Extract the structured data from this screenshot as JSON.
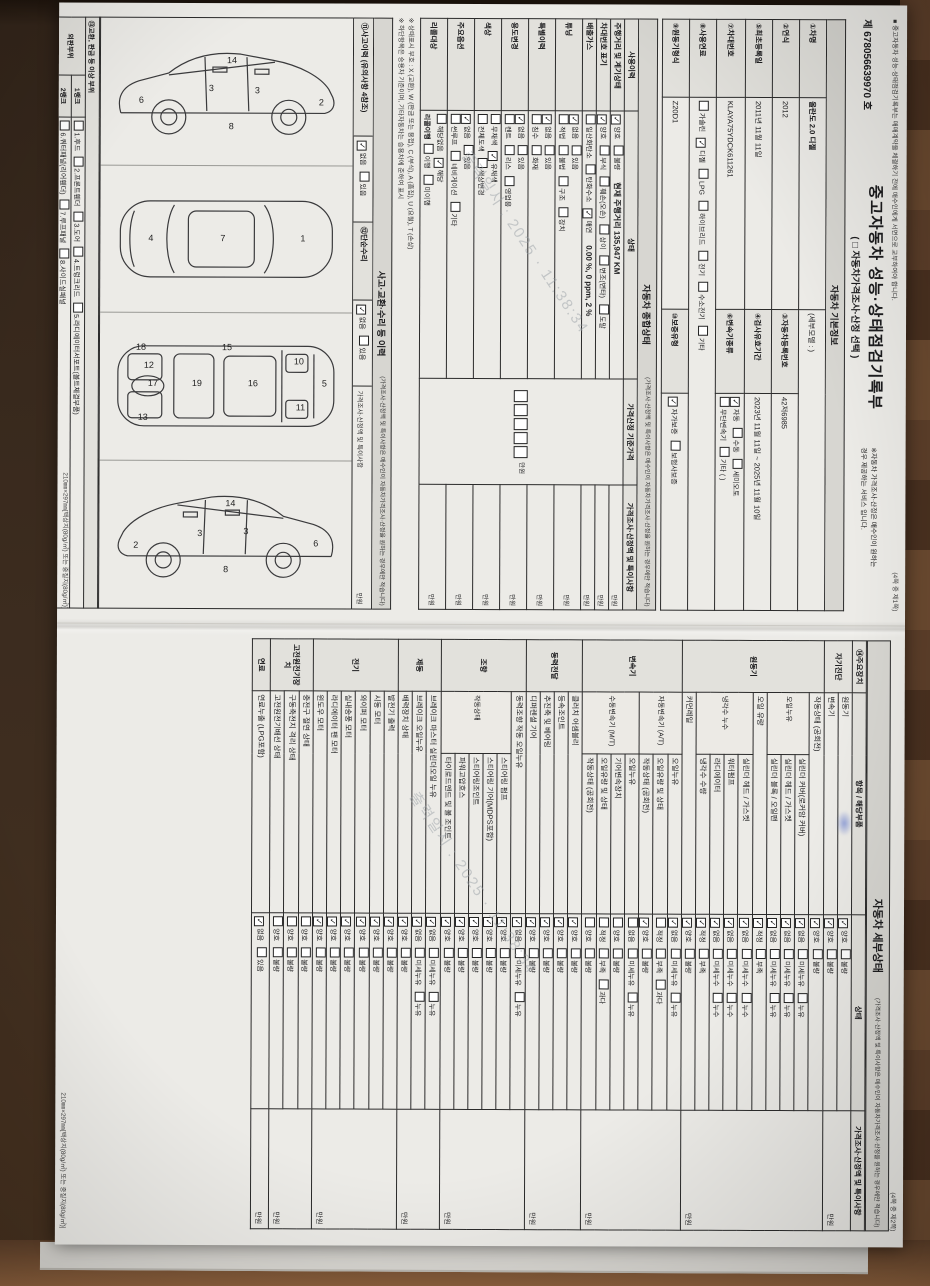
{
  "photo": {
    "watermark_line1": "출력일시 : 2025",
    "watermark_line2": "11:38:34"
  },
  "doc_number": "제 678056639970 호",
  "title": "중고자동차 성능·상태점검기록부",
  "title_sub": "( □ 자동차가격조사·산정 선택 )",
  "title_note1": "※자동차 가격조사·산정은 매수인이 원하는",
  "title_note2": "경우 제공하는 서비스 입니다.",
  "top_notice": "■ 중고자동차 성능·상태점검기록부는 매매계약을 체결하기 전에 매수인에게 서면으로 교부하여야 합니다.",
  "page1_marker": "(4쪽 중 제1쪽)",
  "page2_marker": "(4쪽 중 제2쪽)",
  "footer_spec": "210㎜×297㎜[백상지(80g/㎡) 또는 중질지(80g/㎡)]",
  "price_note": "(가격조사·산정액 및 특이사항은 매수인이 자동차가격조사·산정을 원하는 경우에만 적습니다)",
  "section_basic": "자동차 기본정보",
  "section_overall": "자동차 종합상태",
  "section_accident": "사고·교환·수리 등 이력",
  "section_detail": "자동차 세부상태",
  "basic": {
    "f1_label": "①차명",
    "f1_value": "올란도 2.0 디젤",
    "f1_extra": "(세부모델 : )",
    "f2_label": "②연식",
    "f2_value": "2012",
    "f3_label": "③자동차등록번호",
    "f3_value": "42저6985",
    "f4_label": "④검사유효기간",
    "f4_value": "2023년 11월 11일 ~ 2025년 11월 10일",
    "f5_label": "⑤최초등록일",
    "f5_value": "2011년 11월 11일",
    "f6_label": "⑥변속기종류",
    "trans_options1": [
      [
        "자동",
        1
      ],
      [
        "수동",
        0
      ],
      [
        "세미오토",
        0
      ]
    ],
    "trans_options2": [
      [
        "무단변속기",
        0
      ],
      [
        "기타 (      )",
        0
      ]
    ],
    "f7_label": "⑦차대번호",
    "f7_value": "KLAYA75YDCK611261",
    "f8_label": "⑧사용연료",
    "fuel_options": [
      [
        "가솔린",
        0
      ],
      [
        "디젤",
        1
      ],
      [
        "LPG",
        0
      ],
      [
        "하이브리드",
        0
      ],
      [
        "전기",
        0
      ],
      [
        "수소전기",
        0
      ],
      [
        "기타",
        0
      ]
    ],
    "f9_label": "⑨원동기형식",
    "f9_value": "Z20D1",
    "f10_label": "⑩보증유형",
    "warranty_options": [
      [
        "자가보증",
        1
      ],
      [
        "보험사보증",
        0
      ]
    ]
  },
  "overall": {
    "header": [
      "사용이력",
      "상태",
      "가격산정 기준가격",
      "가격조사·산정액 및 특이사항"
    ],
    "price_unit": "만원",
    "rows": [
      {
        "label": "주행거리 및 계기상태",
        "opts": [
          [
            "양호",
            1
          ],
          [
            "불량",
            0
          ]
        ],
        "note": "현재 주행거리  135,947 KM"
      },
      {
        "label": "차대번호 표기",
        "opts": [
          [
            "양호",
            1
          ],
          [
            "부식",
            0
          ],
          [
            "훼손(오손)",
            0
          ],
          [
            "상이",
            0
          ],
          [
            "변조(변타)",
            0
          ],
          [
            "도말",
            0
          ]
        ]
      },
      {
        "label": "배출가스",
        "opts": [
          [
            "일산화탄소",
            0
          ],
          [
            "탄화수소",
            0
          ],
          [
            "매연",
            1
          ]
        ],
        "note": "0.00 %,  0 ppm,  2 %"
      },
      {
        "label": "튜닝",
        "opts": [
          [
            "없음",
            1
          ],
          [
            "있음",
            0
          ]
        ],
        "opts2": [
          [
            "적법",
            0
          ],
          [
            "불법",
            0
          ]
        ],
        "opts3": [
          [
            "구조",
            0
          ],
          [
            "장치",
            0
          ]
        ]
      },
      {
        "label": "특별이력",
        "opts": [
          [
            "없음",
            1
          ],
          [
            "있음",
            0
          ]
        ],
        "opts2": [
          [
            "침수",
            0
          ],
          [
            "화재",
            0
          ]
        ]
      },
      {
        "label": "용도변경",
        "opts": [
          [
            "없음",
            1
          ],
          [
            "있음",
            0
          ]
        ],
        "opts2": [
          [
            "렌트",
            0
          ],
          [
            "리스",
            0
          ],
          [
            "영업용",
            0
          ]
        ]
      },
      {
        "label": "색상",
        "opts": [
          [
            "무채색",
            0
          ],
          [
            "유채색",
            1
          ]
        ],
        "opts2": [
          [
            "전체도색",
            0
          ],
          [
            "색상변경",
            0
          ]
        ]
      },
      {
        "label": "주요옵션",
        "opts": [
          [
            "없음",
            1
          ],
          [
            "있음",
            0
          ]
        ],
        "opts2": [
          [
            "썬루프",
            0
          ],
          [
            "네비게이션",
            0
          ],
          [
            "기타",
            0
          ]
        ]
      },
      {
        "label": "리콜대상",
        "opts": [
          [
            "해당없음",
            0
          ],
          [
            "해당",
            1
          ]
        ],
        "sub2": "리콜이행",
        "opts2": [
          [
            "이행",
            0
          ],
          [
            "미이행",
            0
          ]
        ]
      }
    ]
  },
  "legend_note1": "※ 상태표시 부호 :  X (교환),  W (판금 또는 용접),  C (부식),  A (흠집),  U (요철),  T (손상)",
  "legend_note2": "※ 하단항목은 승용차 기준이며, 기타자동차는 승용차에 준하여 표시",
  "accident": {
    "history_label": "⑪사고이력 (유의사항 4참조)",
    "history_options": [
      [
        "없음",
        1
      ],
      [
        "있음",
        0
      ]
    ],
    "repair_label": "⑫단순수리",
    "repair_options": [
      [
        "없음",
        1
      ],
      [
        "있음",
        0
      ]
    ],
    "price_header": "가격조사·산정액 및 특이사항",
    "price_unit": "만원",
    "exchange_label": "⑬교환, 판금 등 이상 부위",
    "check_rows": [
      {
        "group": "외판부위",
        "gspan": 2,
        "rank": "1랭크",
        "items": [
          {
            "t": "1.후드"
          },
          {
            "t": "2.프론트휀더"
          },
          {
            "t": "3.도어"
          },
          {
            "t": "4.트렁크리드"
          },
          {
            "t": "5.라디에이터서포트(볼트체결부품)"
          }
        ]
      },
      {
        "rank": "2랭크",
        "items": [
          {
            "t": "6.쿼터패널(리어휀더)"
          },
          {
            "t": "7.루프패널"
          },
          {
            "t": "8.사이드실패널"
          }
        ]
      },
      {
        "group": "주요골격",
        "gspan": 3,
        "rank": "A랭크",
        "items": [
          {
            "t": "9.프론트패널"
          },
          {
            "t": "10.크로스멤버"
          },
          {
            "t": "11.인사이드패널"
          }
        ]
      },
      {
        "rank": "B랭크",
        "items": [
          {
            "t": "12.사이드멤버"
          },
          {
            "t": "13.휠하우스"
          },
          {
            "t": "14.필러패널",
            "sub": [
              "A",
              "B",
              "C"
            ]
          },
          {
            "t": "15.대쉬패널"
          }
        ]
      },
      {
        "rank": "C랭크",
        "items": [
          {
            "t": "16.플로어패널"
          },
          {
            "t": "17.트렁크플로어"
          },
          {
            "t": "18.리어패널"
          },
          {
            "t": "19.패키지트레이"
          }
        ]
      }
    ],
    "diagrams": {
      "side_right": [
        "6",
        "3",
        "3",
        "2",
        "8",
        "14"
      ],
      "top": [
        "4",
        "7",
        "1"
      ],
      "underbody": [
        "18",
        "12",
        "17",
        "19",
        "13",
        "16",
        "15",
        "10",
        "11",
        "5"
      ],
      "side_left": [
        "2",
        "3",
        "3",
        "6",
        "8",
        "14"
      ]
    }
  },
  "detail": {
    "header": [
      "⑭주요장치",
      "항목 / 해당부품",
      "상태",
      "가격조사·산정액 및 특이사항"
    ],
    "state_header": "상태",
    "price_unit": "만원",
    "sections": [
      {
        "n": "자기진단",
        "rows": [
          {
            "l": "원동기",
            "o": [
              [
                "양호",
                1
              ],
              [
                "불량",
                0
              ]
            ]
          },
          {
            "l": "변속기",
            "o": [
              [
                "양호",
                1
              ],
              [
                "불량",
                0
              ]
            ]
          }
        ]
      },
      {
        "n": "원동기",
        "rows": [
          {
            "l": "작동상태 (공회전)",
            "o": [
              [
                "양호",
                1
              ],
              [
                "불량",
                0
              ]
            ]
          },
          {
            "g": "오일누유",
            "s": 3,
            "l": "실린더 커버(로커암 커버)",
            "o": [
              [
                "없음",
                1
              ],
              [
                "미세누유",
                0
              ],
              [
                "누유",
                0
              ]
            ]
          },
          {
            "l": "실린더 헤드 / 가스켓",
            "o": [
              [
                "없음",
                1
              ],
              [
                "미세누유",
                0
              ],
              [
                "누유",
                0
              ]
            ]
          },
          {
            "l": "실린더 블록 / 오일팬",
            "o": [
              [
                "없음",
                1
              ],
              [
                "미세누유",
                0
              ],
              [
                "누유",
                0
              ]
            ]
          },
          {
            "l": "오일 유량",
            "o": [
              [
                "적정",
                1
              ],
              [
                "부족",
                0
              ]
            ]
          },
          {
            "g": "냉각수 누수",
            "s": 4,
            "l": "실린더 헤드 / 가스켓",
            "o": [
              [
                "없음",
                1
              ],
              [
                "미세누수",
                0
              ],
              [
                "누수",
                0
              ]
            ]
          },
          {
            "l": "워터펌프",
            "o": [
              [
                "없음",
                1
              ],
              [
                "미세누수",
                0
              ],
              [
                "누수",
                0
              ]
            ]
          },
          {
            "l": "라디에이터",
            "o": [
              [
                "없음",
                1
              ],
              [
                "미세누수",
                0
              ],
              [
                "누수",
                0
              ]
            ]
          },
          {
            "l": "냉각수 수량",
            "o": [
              [
                "적정",
                1
              ],
              [
                "부족",
                0
              ]
            ]
          },
          {
            "l": "커먼레일",
            "o": [
              [
                "양호",
                1
              ],
              [
                "불량",
                0
              ]
            ]
          }
        ]
      },
      {
        "n": "변속기",
        "rows": [
          {
            "g": "자동변속기 (A/T)",
            "s": 3,
            "l": "오일누유",
            "o": [
              [
                "없음",
                1
              ],
              [
                "미세누유",
                0
              ],
              [
                "누유",
                0
              ]
            ]
          },
          {
            "l": "오일유량 및 상태",
            "o": [
              [
                "적정",
                0
              ],
              [
                "부족",
                0
              ],
              [
                "과다",
                0
              ]
            ]
          },
          {
            "l": "작동상태 (공회전)",
            "o": [
              [
                "양호",
                1
              ],
              [
                "불량",
                0
              ]
            ]
          },
          {
            "g": "수동변속기 (M/T)",
            "s": 4,
            "l": "오일누유",
            "o": [
              [
                "없음",
                0
              ],
              [
                "미세누유",
                0
              ],
              [
                "누유",
                0
              ]
            ]
          },
          {
            "l": "기어변속장치",
            "o": [
              [
                "양호",
                0
              ],
              [
                "불량",
                0
              ]
            ]
          },
          {
            "l": "오일유량 및 상태",
            "o": [
              [
                "적정",
                0
              ],
              [
                "부족",
                0
              ],
              [
                "과다",
                0
              ]
            ]
          },
          {
            "l": "작동상태 (공회전)",
            "o": [
              [
                "양호",
                0
              ],
              [
                "불량",
                0
              ]
            ]
          }
        ]
      },
      {
        "n": "동력전달",
        "rows": [
          {
            "l": "클러치 어셈블리",
            "o": [
              [
                "양호",
                1
              ],
              [
                "불량",
                0
              ]
            ]
          },
          {
            "l": "등속조인트",
            "o": [
              [
                "양호",
                1
              ],
              [
                "불량",
                0
              ]
            ]
          },
          {
            "l": "추진축 및 베어링",
            "o": [
              [
                "양호",
                1
              ],
              [
                "불량",
                0
              ]
            ]
          },
          {
            "l": "디퍼렌셜 기어",
            "o": [
              [
                "양호",
                1
              ],
              [
                "불량",
                0
              ]
            ]
          }
        ]
      },
      {
        "n": "조향",
        "rows": [
          {
            "l": "동력조향 작동 오일누유",
            "o": [
              [
                "없음",
                1
              ],
              [
                "미세누유",
                0
              ],
              [
                "누유",
                0
              ]
            ]
          },
          {
            "g": "작동상태",
            "s": 5,
            "l": "스티어링 펌프",
            "o": [
              [
                "양호",
                1
              ],
              [
                "불량",
                0
              ]
            ]
          },
          {
            "l": "스티어링 기어(MDPS포함)",
            "o": [
              [
                "양호",
                1
              ],
              [
                "불량",
                0
              ]
            ]
          },
          {
            "l": "스티어링조인트",
            "o": [
              [
                "양호",
                1
              ],
              [
                "불량",
                0
              ]
            ]
          },
          {
            "l": "파워고압호스",
            "o": [
              [
                "양호",
                1
              ],
              [
                "불량",
                0
              ]
            ]
          },
          {
            "l": "타이로드엔드 및 볼 조인트",
            "o": [
              [
                "양호",
                1
              ],
              [
                "불량",
                0
              ]
            ]
          }
        ]
      },
      {
        "n": "제동",
        "rows": [
          {
            "l": "브레이크 마스터 실린더오일 누유",
            "o": [
              [
                "없음",
                1
              ],
              [
                "미세누유",
                0
              ],
              [
                "누유",
                0
              ]
            ]
          },
          {
            "l": "브레이크 오일누유",
            "o": [
              [
                "없음",
                1
              ],
              [
                "미세누유",
                0
              ],
              [
                "누유",
                0
              ]
            ]
          },
          {
            "l": "배력장치 상태",
            "o": [
              [
                "양호",
                1
              ],
              [
                "불량",
                0
              ]
            ]
          }
        ]
      },
      {
        "n": "전기",
        "rows": [
          {
            "l": "발전기 출력",
            "o": [
              [
                "양호",
                1
              ],
              [
                "불량",
                0
              ]
            ]
          },
          {
            "l": "시동 모터",
            "o": [
              [
                "양호",
                1
              ],
              [
                "불량",
                0
              ]
            ]
          },
          {
            "l": "와이퍼 모터",
            "o": [
              [
                "양호",
                1
              ],
              [
                "불량",
                0
              ]
            ]
          },
          {
            "l": "실내송풍 모터",
            "o": [
              [
                "양호",
                1
              ],
              [
                "불량",
                0
              ]
            ]
          },
          {
            "l": "라디에이터 팬 모터",
            "o": [
              [
                "양호",
                1
              ],
              [
                "불량",
                0
              ]
            ]
          },
          {
            "l": "윈도우 모터",
            "o": [
              [
                "양호",
                1
              ],
              [
                "불량",
                0
              ]
            ]
          }
        ]
      },
      {
        "n": "고전원전기장치",
        "rows": [
          {
            "l": "충전구 절연 상태",
            "o": [
              [
                "양호",
                0
              ],
              [
                "불량",
                0
              ]
            ]
          },
          {
            "l": "구동축전지 격리 상태",
            "o": [
              [
                "양호",
                0
              ],
              [
                "불량",
                0
              ]
            ]
          },
          {
            "l": "고전원전기배선 상태",
            "o": [
              [
                "양호",
                0
              ],
              [
                "불량",
                0
              ]
            ]
          }
        ]
      },
      {
        "n": "연료",
        "rows": [
          {
            "l": "연료누출 (LPG포함)",
            "o": [
              [
                "없음",
                1
              ],
              [
                "있음",
                0
              ]
            ]
          }
        ]
      }
    ]
  }
}
